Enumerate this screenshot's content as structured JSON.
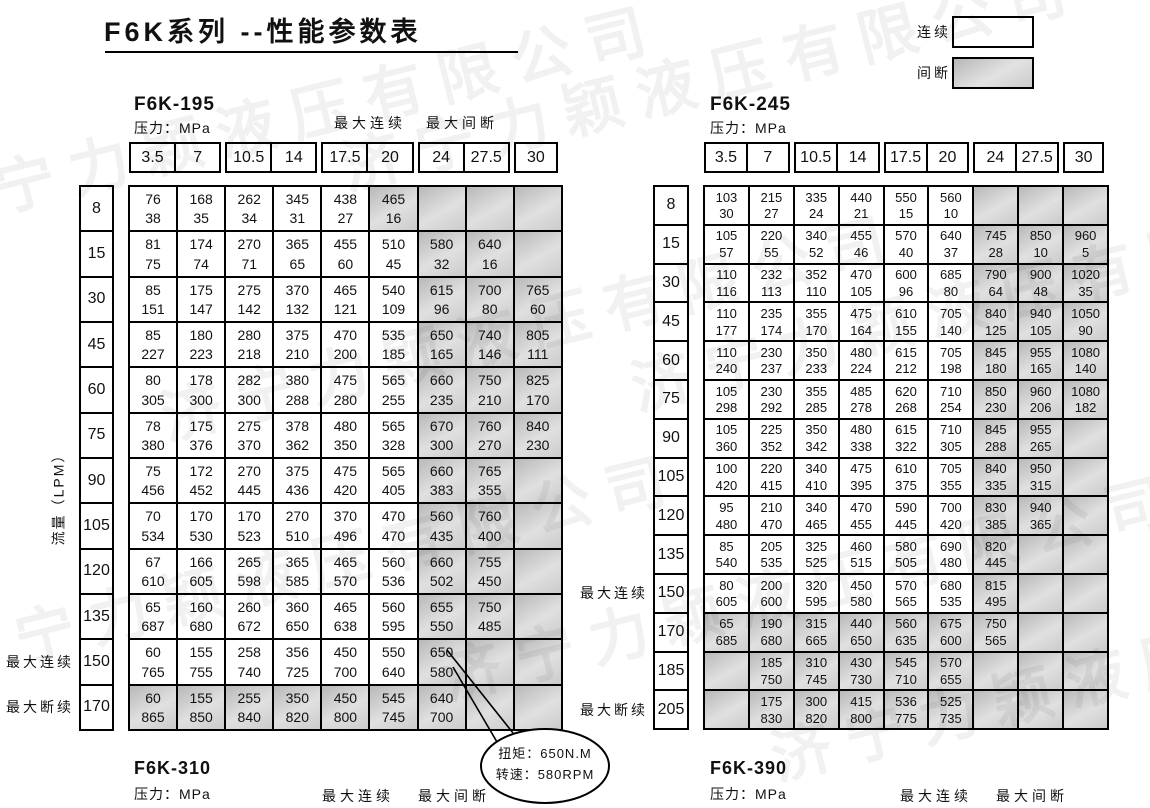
{
  "page": {
    "title": "F6K系列 --性能参数表"
  },
  "legend": {
    "continuous": "连续",
    "intermittent": "间断"
  },
  "labels": {
    "pressure": "压力：MPa",
    "max_continuous": "最大连续",
    "max_intermittent": "最大间断",
    "max_discontinuous": "最大断续",
    "flow_axis": "流量（LPM）"
  },
  "pressure_columns": [
    "3.5",
    "7",
    "10.5",
    "14",
    "17.5",
    "20",
    "24",
    "27.5",
    "30"
  ],
  "tables": {
    "f6k195": {
      "name": "F6K-195",
      "flows": [
        "8",
        "15",
        "30",
        "45",
        "60",
        "75",
        "90",
        "105",
        "120",
        "135",
        "150",
        "170"
      ],
      "side_labels": [
        {
          "row": 10,
          "text": "最大连续"
        },
        {
          "row": 11,
          "text": "最大断续"
        }
      ],
      "gray_start": [
        5,
        6,
        6,
        6,
        6,
        6,
        6,
        6,
        6,
        6,
        6,
        0
      ],
      "cells": [
        [
          [
            76,
            38
          ],
          [
            168,
            35
          ],
          [
            262,
            34
          ],
          [
            345,
            31
          ],
          [
            438,
            27
          ],
          [
            465,
            16
          ],
          null,
          null,
          null
        ],
        [
          [
            81,
            75
          ],
          [
            174,
            74
          ],
          [
            270,
            71
          ],
          [
            365,
            65
          ],
          [
            455,
            60
          ],
          [
            510,
            45
          ],
          [
            580,
            32
          ],
          [
            640,
            16
          ],
          null
        ],
        [
          [
            85,
            151
          ],
          [
            175,
            147
          ],
          [
            275,
            142
          ],
          [
            370,
            132
          ],
          [
            465,
            121
          ],
          [
            540,
            109
          ],
          [
            615,
            96
          ],
          [
            700,
            80
          ],
          [
            765,
            60
          ]
        ],
        [
          [
            85,
            227
          ],
          [
            180,
            223
          ],
          [
            280,
            218
          ],
          [
            375,
            210
          ],
          [
            470,
            200
          ],
          [
            535,
            185
          ],
          [
            650,
            165
          ],
          [
            740,
            146
          ],
          [
            805,
            111
          ]
        ],
        [
          [
            80,
            305
          ],
          [
            178,
            300
          ],
          [
            282,
            300
          ],
          [
            380,
            288
          ],
          [
            475,
            280
          ],
          [
            565,
            255
          ],
          [
            660,
            235
          ],
          [
            750,
            210
          ],
          [
            825,
            170
          ]
        ],
        [
          [
            78,
            380
          ],
          [
            175,
            376
          ],
          [
            275,
            370
          ],
          [
            378,
            362
          ],
          [
            480,
            350
          ],
          [
            565,
            328
          ],
          [
            670,
            300
          ],
          [
            760,
            270
          ],
          [
            840,
            230
          ]
        ],
        [
          [
            75,
            456
          ],
          [
            172,
            452
          ],
          [
            270,
            445
          ],
          [
            375,
            436
          ],
          [
            475,
            420
          ],
          [
            565,
            405
          ],
          [
            660,
            383
          ],
          [
            765,
            355
          ],
          null
        ],
        [
          [
            70,
            534
          ],
          [
            170,
            530
          ],
          [
            170,
            523
          ],
          [
            270,
            510
          ],
          [
            370,
            496
          ],
          [
            470,
            470
          ],
          [
            560,
            435
          ],
          [
            760,
            400
          ],
          null
        ],
        [
          [
            67,
            610
          ],
          [
            166,
            605
          ],
          [
            265,
            598
          ],
          [
            365,
            585
          ],
          [
            465,
            570
          ],
          [
            560,
            536
          ],
          [
            660,
            502
          ],
          [
            755,
            450
          ],
          null
        ],
        [
          [
            65,
            687
          ],
          [
            160,
            680
          ],
          [
            260,
            672
          ],
          [
            360,
            650
          ],
          [
            465,
            638
          ],
          [
            560,
            595
          ],
          [
            655,
            550
          ],
          [
            750,
            485
          ],
          null
        ],
        [
          [
            60,
            765
          ],
          [
            155,
            755
          ],
          [
            258,
            740
          ],
          [
            356,
            725
          ],
          [
            450,
            700
          ],
          [
            550,
            640
          ],
          [
            650,
            580
          ],
          null,
          null
        ],
        [
          [
            60,
            865
          ],
          [
            155,
            850
          ],
          [
            255,
            840
          ],
          [
            350,
            820
          ],
          [
            450,
            800
          ],
          [
            545,
            745
          ],
          [
            640,
            700
          ],
          null,
          null
        ]
      ]
    },
    "f6k245": {
      "name": "F6K-245",
      "flows": [
        "8",
        "15",
        "30",
        "45",
        "60",
        "75",
        "90",
        "105",
        "120",
        "135",
        "150",
        "170",
        "185",
        "205"
      ],
      "side_labels": [
        {
          "row": 10,
          "text": "最大连续"
        },
        {
          "row": 13,
          "text": "最大断续"
        }
      ],
      "gray_start": [
        6,
        6,
        6,
        6,
        6,
        6,
        6,
        6,
        6,
        6,
        6,
        0,
        0,
        0
      ],
      "cells": [
        [
          [
            103,
            30
          ],
          [
            215,
            27
          ],
          [
            335,
            24
          ],
          [
            440,
            21
          ],
          [
            550,
            15
          ],
          [
            560,
            10
          ],
          null,
          null,
          null
        ],
        [
          [
            105,
            57
          ],
          [
            220,
            55
          ],
          [
            340,
            52
          ],
          [
            455,
            46
          ],
          [
            570,
            40
          ],
          [
            640,
            37
          ],
          [
            745,
            28
          ],
          [
            850,
            10
          ],
          [
            960,
            5
          ]
        ],
        [
          [
            110,
            116
          ],
          [
            232,
            113
          ],
          [
            352,
            110
          ],
          [
            470,
            105
          ],
          [
            600,
            96
          ],
          [
            685,
            80
          ],
          [
            790,
            64
          ],
          [
            900,
            48
          ],
          [
            1020,
            35
          ]
        ],
        [
          [
            110,
            177
          ],
          [
            235,
            174
          ],
          [
            355,
            170
          ],
          [
            475,
            164
          ],
          [
            610,
            155
          ],
          [
            705,
            140
          ],
          [
            840,
            125
          ],
          [
            940,
            105
          ],
          [
            1050,
            90
          ]
        ],
        [
          [
            110,
            240
          ],
          [
            230,
            237
          ],
          [
            350,
            233
          ],
          [
            480,
            224
          ],
          [
            615,
            212
          ],
          [
            705,
            198
          ],
          [
            845,
            180
          ],
          [
            955,
            165
          ],
          [
            1080,
            140
          ]
        ],
        [
          [
            105,
            298
          ],
          [
            230,
            292
          ],
          [
            355,
            285
          ],
          [
            485,
            278
          ],
          [
            620,
            268
          ],
          [
            710,
            254
          ],
          [
            850,
            230
          ],
          [
            960,
            206
          ],
          [
            1080,
            182
          ]
        ],
        [
          [
            105,
            360
          ],
          [
            225,
            352
          ],
          [
            350,
            342
          ],
          [
            480,
            338
          ],
          [
            615,
            322
          ],
          [
            710,
            305
          ],
          [
            845,
            288
          ],
          [
            955,
            265
          ],
          null
        ],
        [
          [
            100,
            420
          ],
          [
            220,
            415
          ],
          [
            340,
            410
          ],
          [
            475,
            395
          ],
          [
            610,
            375
          ],
          [
            705,
            355
          ],
          [
            840,
            335
          ],
          [
            950,
            315
          ],
          null
        ],
        [
          [
            95,
            480
          ],
          [
            210,
            470
          ],
          [
            340,
            465
          ],
          [
            470,
            455
          ],
          [
            590,
            445
          ],
          [
            700,
            420
          ],
          [
            830,
            385
          ],
          [
            940,
            365
          ],
          null
        ],
        [
          [
            85,
            540
          ],
          [
            205,
            535
          ],
          [
            325,
            525
          ],
          [
            460,
            515
          ],
          [
            580,
            505
          ],
          [
            690,
            480
          ],
          [
            820,
            445
          ],
          null,
          null
        ],
        [
          [
            80,
            605
          ],
          [
            200,
            600
          ],
          [
            320,
            595
          ],
          [
            450,
            580
          ],
          [
            570,
            565
          ],
          [
            680,
            535
          ],
          [
            815,
            495
          ],
          null,
          null
        ],
        [
          [
            65,
            685
          ],
          [
            190,
            680
          ],
          [
            315,
            665
          ],
          [
            440,
            650
          ],
          [
            560,
            635
          ],
          [
            675,
            600
          ],
          [
            750,
            565
          ],
          null,
          null
        ],
        [
          null,
          [
            185,
            750
          ],
          [
            310,
            745
          ],
          [
            430,
            730
          ],
          [
            545,
            710
          ],
          [
            570,
            655
          ],
          null,
          null,
          null
        ],
        [
          null,
          [
            175,
            830
          ],
          [
            300,
            820
          ],
          [
            415,
            800
          ],
          [
            536,
            775
          ],
          [
            525,
            735
          ],
          null,
          null,
          null
        ]
      ]
    }
  },
  "callout": {
    "torque": "扭矩：650N.M",
    "speed": "转速：580RPM"
  },
  "footer": {
    "t310": {
      "name": "F6K-310"
    },
    "t390": {
      "name": "F6K-390"
    }
  },
  "watermark": {
    "text": "济宁力颖液压有限公司"
  }
}
